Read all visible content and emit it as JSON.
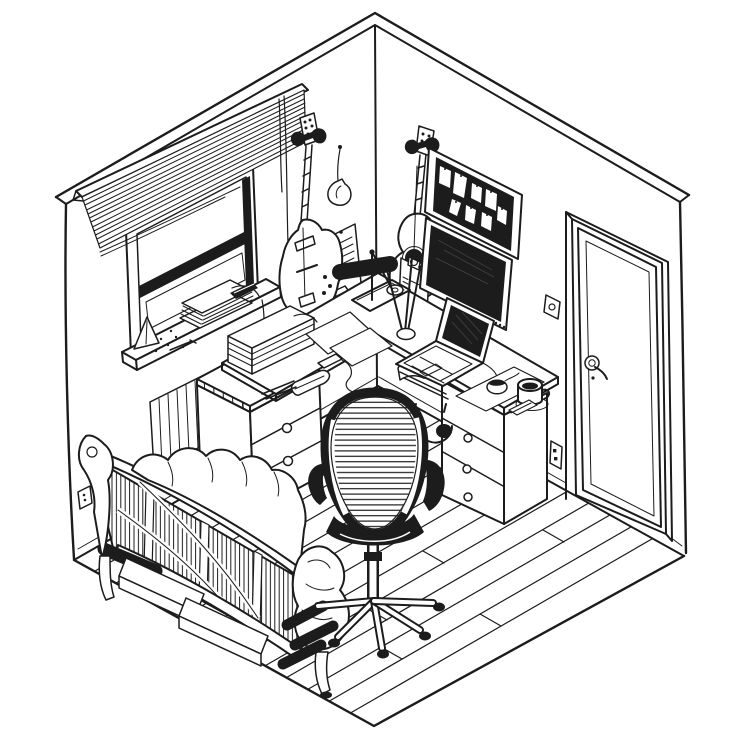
{
  "scene": {
    "title": "Isometric pen-and-ink illustration of a home office music room",
    "style": "hand-drawn black ink line art, isometric cutaway room corner",
    "palette": {
      "paper": "#ffffff",
      "ink": "#1c1c1c"
    },
    "objects": [
      {
        "id": "room-walls",
        "label": "two walls meeting at a corner with top trim"
      },
      {
        "id": "plank-floor",
        "label": "wooden plank floor with staggered seams"
      },
      {
        "id": "window",
        "label": "recessed window with two sashes and deep sill"
      },
      {
        "id": "venetian-blind",
        "label": "half-lowered venetian blind with pull cord"
      },
      {
        "id": "sill-books",
        "label": "stack of books and papers on window sill"
      },
      {
        "id": "metronome",
        "label": "metronome and scattered clutter on sill"
      },
      {
        "id": "electric-guitar",
        "label": "electric guitar on wall hanger"
      },
      {
        "id": "hanging-ornament",
        "label": "small teardrop instrument hanging on string"
      },
      {
        "id": "acoustic-guitar",
        "label": "acoustic guitar on wall hanger"
      },
      {
        "id": "sheet-music",
        "label": "two pinned sheet-music pages with curled corners"
      },
      {
        "id": "pencil-ledge",
        "label": "thin wall ledge above desk"
      },
      {
        "id": "clipboard-checklist",
        "label": "wall clipboard with checkbox list"
      },
      {
        "id": "cork-board",
        "label": "dark cork board with pinned white notes"
      },
      {
        "id": "monitor",
        "label": "widescreen monitor with dark screen"
      },
      {
        "id": "light-switch",
        "label": "round-button light switch"
      },
      {
        "id": "door",
        "label": "panel door with lever handle"
      },
      {
        "id": "wall-outlets",
        "label": "electrical outlets on both walls"
      },
      {
        "id": "corner-desk",
        "label": "L-shaped corner desk"
      },
      {
        "id": "left-pedestal",
        "label": "three-drawer pedestal with ring pulls"
      },
      {
        "id": "right-pedestal",
        "label": "three-drawer pedestal with round knobs"
      },
      {
        "id": "desk-lamp",
        "label": "black articulated desk lamp with weighted base"
      },
      {
        "id": "loose-papers",
        "label": "loose paper sheets on desk"
      },
      {
        "id": "drumsticks-cup",
        "label": "cup with crossed drumsticks and pencils"
      },
      {
        "id": "open-book",
        "label": "open notebook on desk"
      },
      {
        "id": "laptop",
        "label": "laptop with dark screen on riser"
      },
      {
        "id": "mouse-pad",
        "label": "mouse on large mouse pad"
      },
      {
        "id": "coffee-mug",
        "label": "mug on round coaster"
      },
      {
        "id": "sticky-notes",
        "label": "small sticky note pad"
      },
      {
        "id": "headphones",
        "label": "headphones hanging under desk edge"
      },
      {
        "id": "desk-books",
        "label": "tall stack of books on desk end"
      },
      {
        "id": "stapler",
        "label": "stapler and pencils"
      },
      {
        "id": "phone",
        "label": "small phone with trailing cable"
      },
      {
        "id": "radiator",
        "label": "finned radiator against left wall"
      },
      {
        "id": "wastebasket",
        "label": "woven wastebasket"
      },
      {
        "id": "futon-sofa",
        "label": "slatted wooden futon sofa with draped blanket"
      },
      {
        "id": "under-sofa-boxes",
        "label": "flat storage boxes under sofa"
      },
      {
        "id": "rolled-mats",
        "label": "black rolled mats under sofa ends"
      },
      {
        "id": "office-chair",
        "label": "mesh-back office chair on five casters"
      }
    ]
  }
}
